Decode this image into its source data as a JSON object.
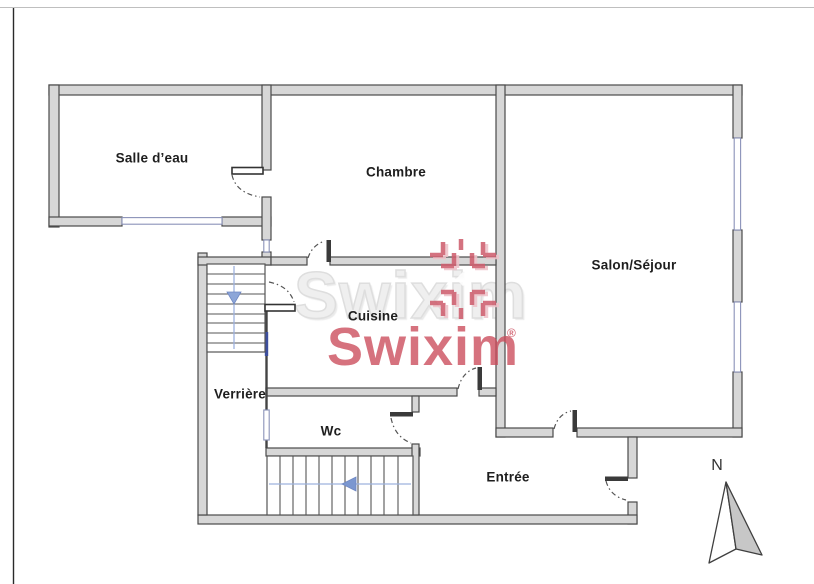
{
  "plan": {
    "rooms": [
      {
        "id": "salle-deau",
        "label": "Salle d’eau"
      },
      {
        "id": "chambre",
        "label": "Chambre"
      },
      {
        "id": "salon-sejour",
        "label": "Salon/Séjour"
      },
      {
        "id": "cuisine",
        "label": "Cuisine"
      },
      {
        "id": "verriere",
        "label": "Verrière"
      },
      {
        "id": "wc",
        "label": "Wc"
      },
      {
        "id": "entree",
        "label": "Entrée"
      }
    ],
    "compass": {
      "north_label": "N"
    },
    "watermark": {
      "background_text": "Swixim",
      "brand_text": "Swixim",
      "registered_mark": "®"
    },
    "colors": {
      "wall_fill": "#d7d7d7",
      "wall_stroke": "#4a4a4a",
      "window_stroke": "#8a92b8",
      "window_dark": "#3d4f9e",
      "stair_arrow": "#8da6d8",
      "brand_pink": "#cf5f6f",
      "watermark_gray": "#e8e8e8"
    }
  }
}
